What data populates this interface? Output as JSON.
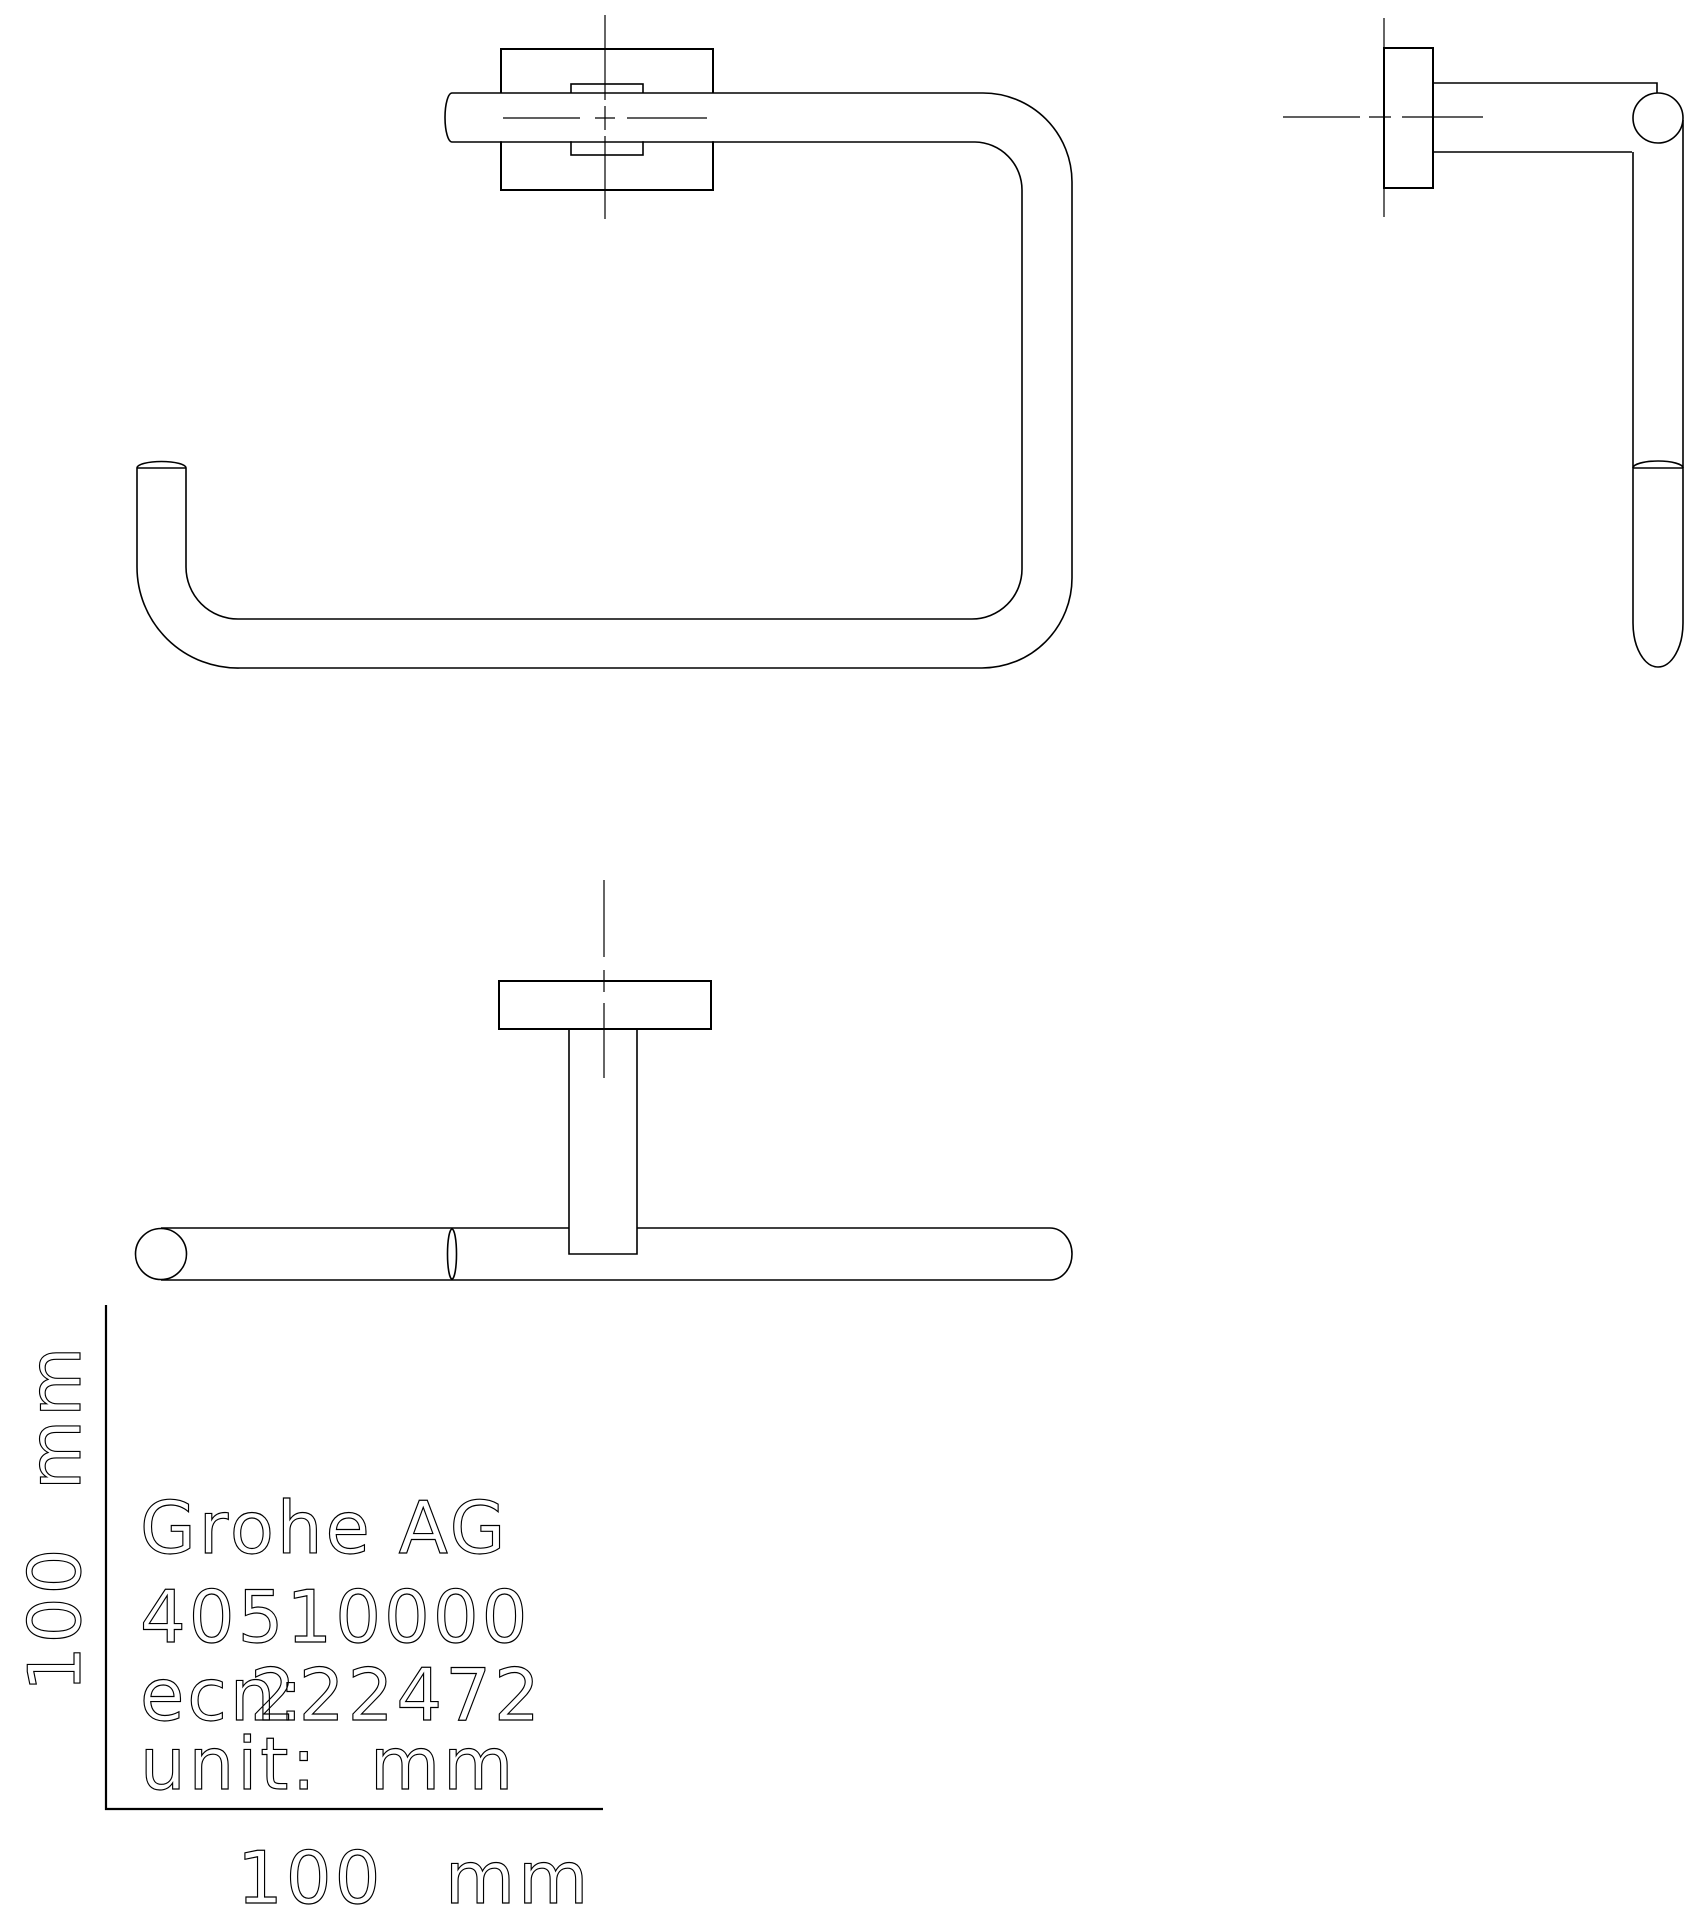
{
  "drawing": {
    "background_color": "#ffffff",
    "line_color": "#000000",
    "title_block": {
      "company": "Grohe AG",
      "product_number": "40510000",
      "ecn_label": "ecn:",
      "ecn_number": "222472",
      "unit_label": "unit:",
      "unit_value": "mm"
    },
    "scale": {
      "x_value": "100",
      "x_unit": "mm",
      "y_value": "100",
      "y_unit": "mm"
    }
  }
}
